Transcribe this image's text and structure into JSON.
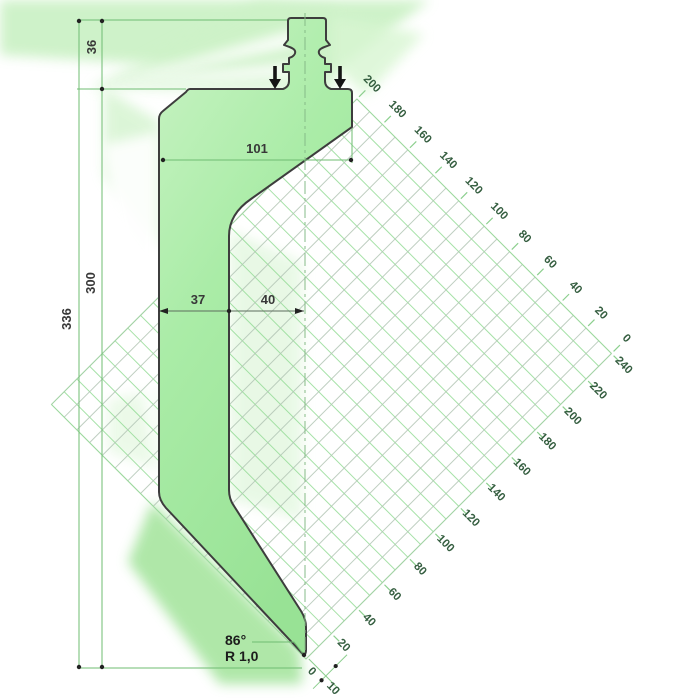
{
  "drawing": {
    "dim_36": "36",
    "dim_300": "300",
    "dim_336": "336",
    "dim_101": "101",
    "dim_37": "37",
    "dim_40": "40",
    "tip_angle": "86°",
    "tip_radius": "R 1,0"
  },
  "scales": {
    "top_right_edge": [
      "200",
      "180",
      "160",
      "140",
      "120",
      "100",
      "80",
      "60",
      "40",
      "20",
      "0"
    ],
    "bottom_right_edge": [
      "240",
      "220",
      "200",
      "180",
      "160",
      "140",
      "120",
      "100",
      "80",
      "60",
      "40",
      "20"
    ],
    "tip_ruler": [
      "0",
      "10"
    ]
  },
  "colors": {
    "punch_fill_light": "#c9f3c4",
    "punch_fill_mid": "#aaeca7",
    "punch_fill_dark": "#98e295",
    "outline": "#3d3d3d",
    "dimension_line_green": "#6fbc72",
    "dimension_line_gray": "#5d6d5d",
    "dimension_text": "#383838",
    "scale_label": "#355e40",
    "hatch_green": "#96dc98",
    "hatch_gray": "#b3c6b6",
    "glow_green": "#c6f0c0",
    "marker_black": "#222222"
  }
}
